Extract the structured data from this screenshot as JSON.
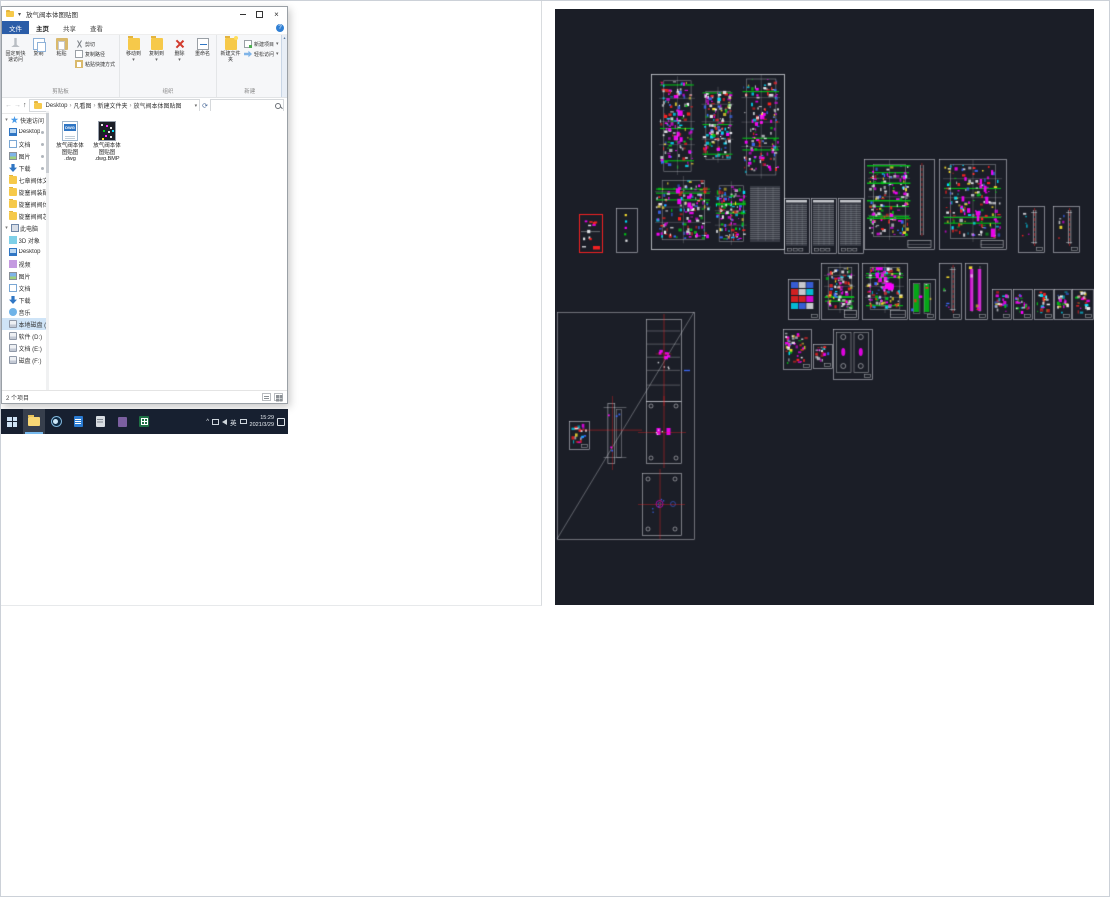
{
  "icons": {
    "back": "←",
    "forward": "→",
    "up_arrow": "↑",
    "caret_down": "▾",
    "crumb_separator": "›",
    "refresh": "⟳",
    "help": "?",
    "close": "×",
    "chevron_up": "^",
    "scroll_up": "▴"
  },
  "explorer": {
    "title": "放气阀本体图贴图",
    "tabs": [
      {
        "key": "file",
        "label": "文件",
        "accent": true
      },
      {
        "key": "home",
        "label": "主页",
        "selected": true
      },
      {
        "key": "share",
        "label": "共享"
      },
      {
        "key": "view",
        "label": "查看"
      }
    ],
    "ribbon": {
      "groups": [
        {
          "key": "clipboard",
          "label": "剪贴板",
          "large": [
            {
              "key": "pin-to-quick-access",
              "label": "固定到快速访问",
              "icon": "pin"
            },
            {
              "key": "copy",
              "label": "复制",
              "icon": "copy"
            },
            {
              "key": "paste",
              "label": "粘贴",
              "icon": "paste"
            }
          ],
          "small": [
            {
              "key": "cut",
              "label": "剪切",
              "icon": "cut"
            },
            {
              "key": "copy-path",
              "label": "复制路径",
              "icon": "copy-path"
            },
            {
              "key": "paste-shortcut",
              "label": "粘贴快捷方式",
              "icon": "paste-shortcut"
            }
          ]
        },
        {
          "key": "organize",
          "label": "组织",
          "large": [
            {
              "key": "move-to",
              "label": "移动到",
              "icon": "move-to",
              "caret": true
            },
            {
              "key": "copy-to",
              "label": "复制到",
              "icon": "copy-to",
              "caret": true
            },
            {
              "key": "delete",
              "label": "删除",
              "icon": "delete",
              "caret": true
            },
            {
              "key": "rename",
              "label": "重命名",
              "icon": "rename"
            }
          ],
          "small": []
        },
        {
          "key": "new",
          "label": "新建",
          "large": [
            {
              "key": "new-folder",
              "label": "新建文件夹",
              "icon": "new-folder"
            }
          ],
          "small": [
            {
              "key": "new-item",
              "label": "新建项目",
              "icon": "new-item",
              "caret": true
            },
            {
              "key": "easy-access",
              "label": "轻松访问",
              "icon": "easy-access",
              "caret": true
            }
          ]
        },
        {
          "key": "open",
          "label": "打开",
          "large": [
            {
              "key": "properties",
              "label": "属性",
              "icon": "properties",
              "caret": true
            }
          ],
          "small": [
            {
              "key": "open",
              "label": "打开",
              "icon": "open",
              "caret": true
            },
            {
              "key": "edit",
              "label": "编辑",
              "icon": "edit"
            },
            {
              "key": "history",
              "label": "历史记录",
              "icon": "history"
            }
          ]
        },
        {
          "key": "select",
          "label": "选择",
          "large": [],
          "small": [
            {
              "key": "select-all",
              "label": "全部选择",
              "icon": "select-all"
            },
            {
              "key": "select-none",
              "label": "全部取消",
              "icon": "select-none"
            },
            {
              "key": "invert-selection",
              "label": "反向选择",
              "icon": "invert-selection"
            }
          ]
        }
      ]
    },
    "address": {
      "crumbs": [
        "Desktop",
        "凡看图",
        "新建文件夹",
        "放气阀本体图贴图"
      ]
    },
    "search": {
      "placeholder": ""
    },
    "nav": {
      "sections": [
        {
          "header": {
            "label": "快速访问",
            "icon": "quick-access"
          },
          "items": [
            {
              "label": "Desktop",
              "icon": "desktop",
              "pinned": true
            },
            {
              "label": "文档",
              "icon": "documents",
              "pinned": true
            },
            {
              "label": "图片",
              "icon": "pictures",
              "pinned": true
            },
            {
              "label": "下载",
              "icon": "downloads",
              "pinned": true
            },
            {
              "label": "七章阀体文件夹",
              "icon": "folder"
            },
            {
              "label": "旋塞阀装配",
              "icon": "folder"
            },
            {
              "label": "旋塞阀阀体",
              "icon": "folder"
            },
            {
              "label": "旋塞阀阀芯加工",
              "icon": "folder"
            }
          ]
        },
        {
          "header": {
            "label": "此电脑",
            "icon": "this-pc"
          },
          "items": [
            {
              "label": "3D 对象",
              "icon": "folder-3d"
            },
            {
              "label": "Desktop",
              "icon": "desktop"
            },
            {
              "label": "视频",
              "icon": "videos"
            },
            {
              "label": "图片",
              "icon": "pictures"
            },
            {
              "label": "文档",
              "icon": "documents"
            },
            {
              "label": "下载",
              "icon": "downloads"
            },
            {
              "label": "音乐",
              "icon": "music"
            },
            {
              "label": "本地磁盘 (C:)",
              "icon": "disk",
              "selected": true
            },
            {
              "label": "软件 (D:)",
              "icon": "disk"
            },
            {
              "label": "文档 (E:)",
              "icon": "disk"
            },
            {
              "label": "磁盘 (F:)",
              "icon": "disk"
            }
          ]
        }
      ]
    },
    "files": [
      {
        "type": "dwg",
        "badge": "DWG",
        "name": "放气阀本体图贴图.dwg",
        "label_lines": [
          "放气阀本体",
          "图贴图",
          ".dwg"
        ]
      },
      {
        "type": "bmp",
        "name": "放气阀本体图贴图.dwg.BMP",
        "label_lines": [
          "放气阀本体",
          "图贴图",
          ".dwg.BMP"
        ]
      }
    ],
    "status": {
      "items_count": "2 个项目"
    }
  },
  "taskbar": {
    "apps": [
      {
        "name": "start"
      },
      {
        "name": "file-explorer",
        "active": true
      },
      {
        "name": "browser"
      },
      {
        "name": "word-doc"
      },
      {
        "name": "app-gray"
      },
      {
        "name": "app-purple"
      },
      {
        "name": "excel"
      }
    ],
    "tray": {
      "ime": "英",
      "time": "15:29",
      "date": "2021/3/29"
    }
  },
  "cad_preview": {
    "size": {
      "w": 539,
      "h": 596
    },
    "palette": {
      "bg": "#1b1e27",
      "frame": "#e4e6ec",
      "white": "#f2f3f7",
      "green": "#00c814",
      "magenta": "#ff00ff",
      "cyan": "#00e0ff",
      "red": "#ff2222",
      "yellow": "#ffe52e",
      "blue": "#3d6bff"
    },
    "sheets": [
      {
        "x": 96,
        "y": 65,
        "w": 133,
        "h": 175,
        "kind": "bigsheet"
      },
      {
        "x": 24,
        "y": 205,
        "w": 23,
        "h": 38,
        "kind": "selected"
      },
      {
        "x": 61,
        "y": 199,
        "w": 21,
        "h": 44,
        "kind": "parts-sparse"
      },
      {
        "x": 229,
        "y": 189,
        "w": 25,
        "h": 55,
        "kind": "table"
      },
      {
        "x": 256,
        "y": 189,
        "w": 25,
        "h": 55,
        "kind": "table"
      },
      {
        "x": 283,
        "y": 189,
        "w": 25,
        "h": 55,
        "kind": "table"
      },
      {
        "x": 309,
        "y": 150,
        "w": 70,
        "h": 90,
        "kind": "assembly-green"
      },
      {
        "x": 384,
        "y": 150,
        "w": 67,
        "h": 90,
        "kind": "assembly-magenta2"
      },
      {
        "x": 463,
        "y": 197,
        "w": 26,
        "h": 46,
        "kind": "rods"
      },
      {
        "x": 498,
        "y": 197,
        "w": 26,
        "h": 46,
        "kind": "rods"
      },
      {
        "x": 233,
        "y": 270,
        "w": 31,
        "h": 40,
        "kind": "grid"
      },
      {
        "x": 266,
        "y": 254,
        "w": 37,
        "h": 56,
        "kind": "assembly"
      },
      {
        "x": 307,
        "y": 254,
        "w": 45,
        "h": 56,
        "kind": "assembly-magenta"
      },
      {
        "x": 354,
        "y": 270,
        "w": 26,
        "h": 40,
        "kind": "rods-green"
      },
      {
        "x": 384,
        "y": 254,
        "w": 22,
        "h": 56,
        "kind": "rods"
      },
      {
        "x": 410,
        "y": 254,
        "w": 22,
        "h": 56,
        "kind": "rods-magenta"
      },
      {
        "x": 437,
        "y": 280,
        "w": 19,
        "h": 30,
        "kind": "parts"
      },
      {
        "x": 458,
        "y": 280,
        "w": 19,
        "h": 30,
        "kind": "parts"
      },
      {
        "x": 479,
        "y": 280,
        "w": 19,
        "h": 30,
        "kind": "parts"
      },
      {
        "x": 499,
        "y": 280,
        "w": 17,
        "h": 30,
        "kind": "parts"
      },
      {
        "x": 517,
        "y": 280,
        "w": 21,
        "h": 30,
        "kind": "parts"
      },
      {
        "x": 228,
        "y": 320,
        "w": 28,
        "h": 40,
        "kind": "parts"
      },
      {
        "x": 258,
        "y": 335,
        "w": 19,
        "h": 24,
        "kind": "parts"
      },
      {
        "x": 278,
        "y": 320,
        "w": 39,
        "h": 50,
        "kind": "ovals"
      },
      {
        "x": 2,
        "y": 303,
        "w": 137,
        "h": 227,
        "kind": "zoomwin"
      },
      {
        "x": 91,
        "y": 310,
        "w": 35,
        "h": 82,
        "kind": "plate-magenta"
      },
      {
        "x": 91,
        "y": 392,
        "w": 35,
        "h": 62,
        "kind": "plate-corners"
      },
      {
        "x": 87,
        "y": 464,
        "w": 39,
        "h": 62,
        "kind": "plate-circles"
      },
      {
        "x": 14,
        "y": 412,
        "w": 20,
        "h": 28,
        "kind": "parts"
      },
      {
        "x": 41,
        "y": 390,
        "w": 38,
        "h": 68,
        "kind": "free-part"
      }
    ]
  }
}
